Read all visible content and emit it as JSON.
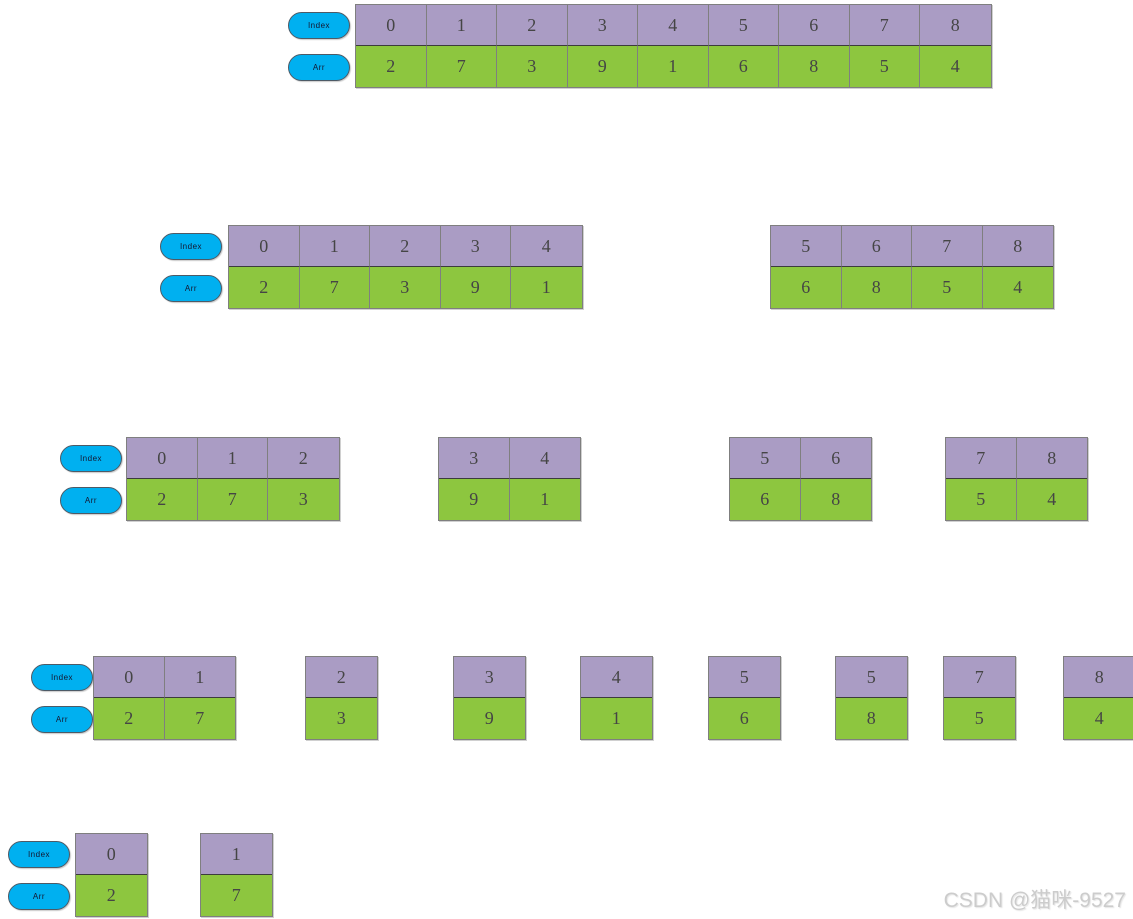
{
  "labels": {
    "index_pill": "Index",
    "arr_pill": "Arr"
  },
  "watermark": "CSDN @猫咪-9527",
  "colors": {
    "index_fill": "#aa9cc4",
    "arr_fill": "#8dc63f",
    "pill_fill": "#00b0f0",
    "cell_border": "#7f7f7f",
    "row_divider": "#3c3c3c",
    "number_text": "#454545",
    "watermark_text": "#cccccc"
  },
  "layout": {
    "cell_width": 70.5,
    "sub_row_height": 41,
    "pill_width": 62,
    "pill_height": 27,
    "pill_index_offset_y": 8,
    "pill_arr_offset_y": 50
  },
  "diagram": {
    "description": "Merge-sort style recursive split of an array into halves, shown over five stages",
    "rows": [
      {
        "y": 4,
        "groups": [
          {
            "x": 355,
            "pill_x": 288,
            "indices": [
              "0",
              "1",
              "2",
              "3",
              "4",
              "5",
              "6",
              "7",
              "8"
            ],
            "values": [
              "2",
              "7",
              "3",
              "9",
              "1",
              "6",
              "8",
              "5",
              "4"
            ]
          }
        ]
      },
      {
        "y": 225,
        "groups": [
          {
            "x": 228,
            "pill_x": 160,
            "indices": [
              "0",
              "1",
              "2",
              "3",
              "4"
            ],
            "values": [
              "2",
              "7",
              "3",
              "9",
              "1"
            ]
          },
          {
            "x": 770,
            "indices": [
              "5",
              "6",
              "7",
              "8"
            ],
            "values": [
              "6",
              "8",
              "5",
              "4"
            ]
          }
        ]
      },
      {
        "y": 437,
        "groups": [
          {
            "x": 126,
            "pill_x": 60,
            "indices": [
              "0",
              "1",
              "2"
            ],
            "values": [
              "2",
              "7",
              "3"
            ]
          },
          {
            "x": 438,
            "indices": [
              "3",
              "4"
            ],
            "values": [
              "9",
              "1"
            ]
          },
          {
            "x": 729,
            "indices": [
              "5",
              "6"
            ],
            "values": [
              "6",
              "8"
            ]
          },
          {
            "x": 945,
            "indices": [
              "7",
              "8"
            ],
            "values": [
              "5",
              "4"
            ]
          }
        ]
      },
      {
        "y": 656,
        "groups": [
          {
            "x": 93,
            "pill_x": 31,
            "indices": [
              "0",
              "1"
            ],
            "values": [
              "2",
              "7"
            ]
          },
          {
            "x": 305,
            "indices": [
              "2"
            ],
            "values": [
              "3"
            ]
          },
          {
            "x": 453,
            "indices": [
              "3"
            ],
            "values": [
              "9"
            ]
          },
          {
            "x": 580,
            "indices": [
              "4"
            ],
            "values": [
              "1"
            ]
          },
          {
            "x": 708,
            "indices": [
              "5"
            ],
            "values": [
              "6"
            ]
          },
          {
            "x": 835,
            "indices": [
              "5"
            ],
            "values": [
              "8"
            ]
          },
          {
            "x": 943,
            "indices": [
              "7"
            ],
            "values": [
              "5"
            ]
          },
          {
            "x": 1063,
            "indices": [
              "8"
            ],
            "values": [
              "4"
            ]
          }
        ]
      },
      {
        "y": 833,
        "groups": [
          {
            "x": 75,
            "pill_x": 8,
            "indices": [
              "0"
            ],
            "values": [
              "2"
            ]
          },
          {
            "x": 200,
            "indices": [
              "1"
            ],
            "values": [
              "7"
            ]
          }
        ]
      }
    ]
  }
}
